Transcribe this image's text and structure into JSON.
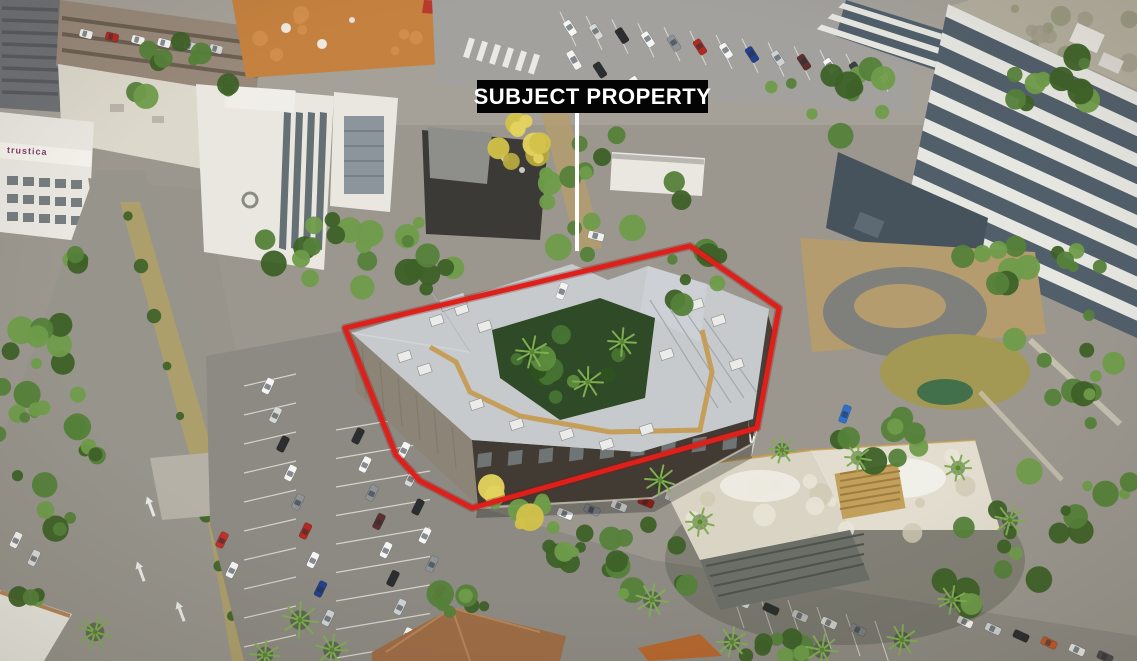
{
  "annotation": {
    "label": "SUBJECT PROPERTY",
    "label_bg": "#040404",
    "label_text_color": "#ffffff",
    "outline_color": "#de201b",
    "leader_color": "#ffffff"
  },
  "signage": {
    "trustica_label": "trustica",
    "trustica_color": "#7c3e68"
  },
  "palette": {
    "base_asphalt": "#9b978f",
    "road": "#97948c",
    "lot_asphalt": "#8d8a83",
    "concrete": "#c9c3b2",
    "median_grass": "#ac9f6c",
    "dirt": "#b49c6e",
    "grass_dry": "#a39955",
    "tree_dark": "#3d6127",
    "tree_mid": "#55813a",
    "tree_light": "#6f9c4a",
    "palm": "#7fae52",
    "yellow_tree": "#d2c24a",
    "yellow_tree2": "#e4d35e",
    "roof_light": "#c6cacd",
    "roof_mid": "#b3b7bb",
    "roof_shade": "#a2a6aa",
    "wall_concrete": "#8d8478",
    "wall_dark": "#423b33",
    "glass_dark": "#2e2b27",
    "glass_glint": "#a7bcc4",
    "walkway": "#c49a4e",
    "white_bldg": "#e9e7e0",
    "white_roof": "#dcd8cc",
    "window_dark": "#4e5a62",
    "plaza": "#c5813f",
    "awning_red": "#b93a2c",
    "terracotta": "#9d6c46",
    "terracotta_light": "#b5855a",
    "garage_wall": "#515f6b",
    "garage_stripe": "#e7e7e2",
    "garage_roof": "#b4af9f",
    "charcoal": "#3c3a36",
    "car_colors": [
      "#f5f5f3",
      "#d8d8d6",
      "#2d2d2d",
      "#f5f5f3",
      "#8e9398",
      "#b22a20",
      "#f5f5f3",
      "#23408c",
      "#cfd2d4",
      "#5d2f2f",
      "#f5f5f3",
      "#3a3f44"
    ]
  }
}
